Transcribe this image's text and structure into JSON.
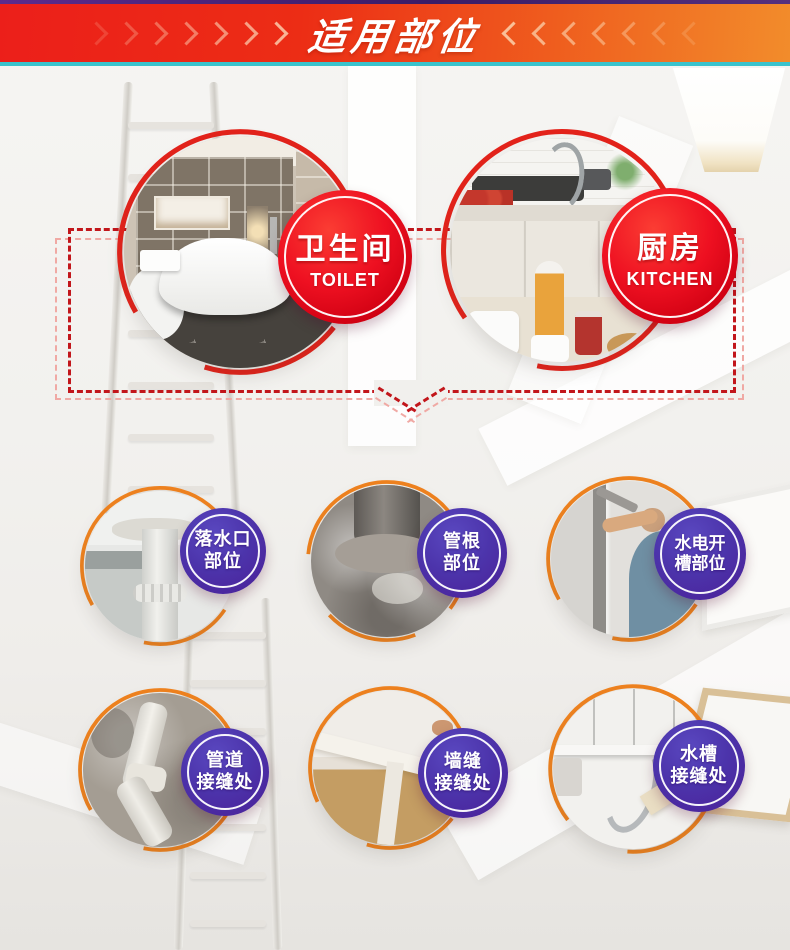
{
  "header": {
    "title": "适用部位",
    "chevron_count": 7,
    "left_chevron_icon": "chevron-right-icon",
    "right_chevron_icon": "chevron-left-icon"
  },
  "rooms": [
    {
      "label": "卫生间",
      "sublabel": "TOILET"
    },
    {
      "label": "厨房",
      "sublabel": "KITCHEN"
    }
  ],
  "spots": [
    {
      "line1": "落水口",
      "line2": "部位"
    },
    {
      "line1": "管根",
      "line2": "部位"
    },
    {
      "line1": "水电开",
      "line2": "槽部位"
    },
    {
      "line1": "管道",
      "line2": "接缝处"
    },
    {
      "line1": "墙缝",
      "line2": "接缝处"
    },
    {
      "line1": "水槽",
      "line2": "接缝处"
    }
  ],
  "colors": {
    "banner_start": "#ec1f1a",
    "banner_end": "#f28c2b",
    "top_strip": "#5c2b8e",
    "underline": "#3ac3cd",
    "accent_red": "#e4231b",
    "accent_orange": "#f0831f",
    "badge_red": "#e60012",
    "badge_purple": "#4c2fa5",
    "dash_dark": "#c2161b",
    "dash_pink": "#f0a9a4"
  }
}
